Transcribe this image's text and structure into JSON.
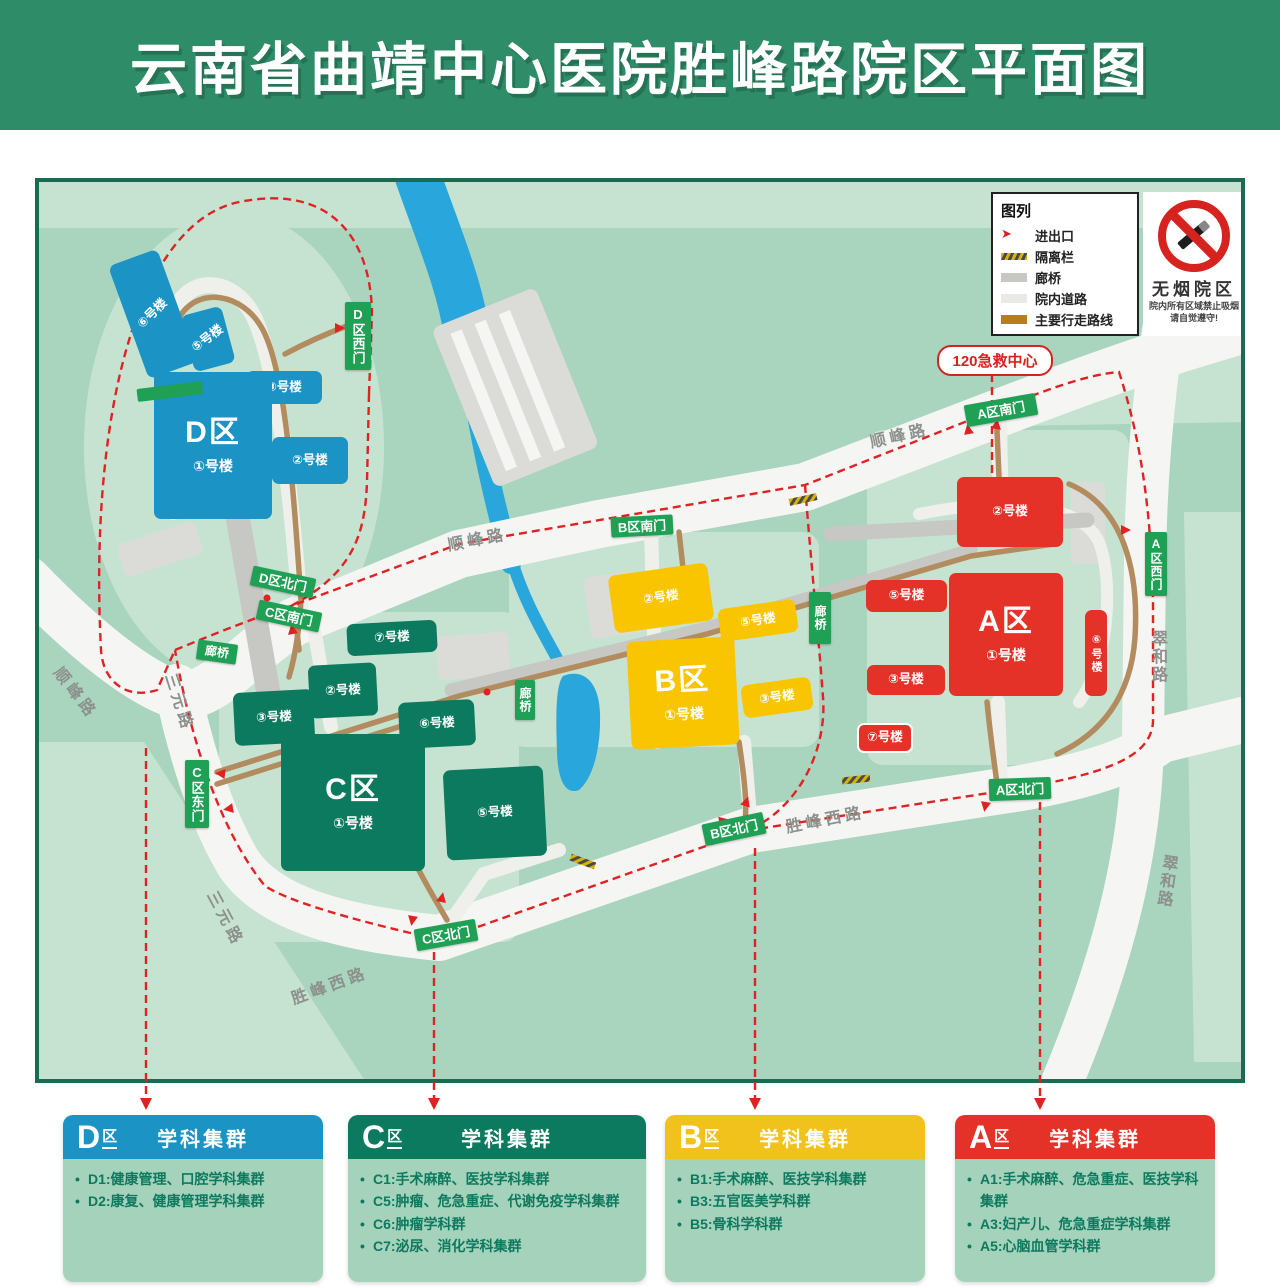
{
  "header": {
    "title": "云南省曲靖中心医院胜峰路院区平面图"
  },
  "legend": {
    "title": "图列",
    "entrance": "进出口",
    "barrier": "隔离栏",
    "corridor": "廊桥",
    "road": "院内道路",
    "route": "主要行走路线"
  },
  "no_smoking": {
    "title": "无烟院区",
    "line1": "院内所有区域禁止吸烟",
    "line2": "请自觉遵守!"
  },
  "emergency_label": "120急救中心",
  "roads": {
    "shunfeng": "顺峰路",
    "sanyuan": "三元路",
    "shengfengxi": "胜峰西路",
    "cuihe": "翠和路"
  },
  "gates": {
    "d_west": "D区西门",
    "d_north": "D区北门",
    "c_south": "C区南门",
    "c_east": "C区东门",
    "c_north": "C区北门",
    "b_south": "B区南门",
    "b_north": "B区北门",
    "a_south": "A区南门",
    "a_west": "A区西门",
    "a_north": "A区北门"
  },
  "corridor_label": "廊桥",
  "zones": {
    "d": {
      "name": "D区",
      "b1": "①号楼",
      "b2": "②号楼",
      "b3": "③号楼",
      "b5": "⑤号楼",
      "b6": "⑥号楼"
    },
    "c": {
      "name": "C区",
      "b1": "①号楼",
      "b2": "②号楼",
      "b3": "③号楼",
      "b5": "⑤号楼",
      "b6": "⑥号楼",
      "b7": "⑦号楼"
    },
    "b": {
      "name": "B区",
      "b1": "①号楼",
      "b2": "②号楼",
      "b3": "③号楼",
      "b5": "⑤号楼"
    },
    "a": {
      "name": "A区",
      "b1": "①号楼",
      "b2": "②号楼",
      "b3": "③号楼",
      "b5": "⑤号楼",
      "b6": "⑥号楼",
      "b7": "⑦号楼"
    }
  },
  "panels": [
    {
      "letter": "D",
      "suffix": "区",
      "title": "学科集群",
      "items": [
        "D1:健康管理、口腔学科集群",
        "D2:康复、健康管理学科集群"
      ]
    },
    {
      "letter": "C",
      "suffix": "区",
      "title": "学科集群",
      "items": [
        "C1:手术麻醉、医技学科集群",
        "C5:肿瘤、危急重症、代谢免疫学科集群",
        "C6:肿瘤学科群",
        "C7:泌尿、消化学科集群"
      ]
    },
    {
      "letter": "B",
      "suffix": "区",
      "title": "学科集群",
      "items": [
        "B1:手术麻醉、医技学科集群",
        "B3:五官医美学科群",
        "B5:骨科学科群"
      ]
    },
    {
      "letter": "A",
      "suffix": "区",
      "title": "学科集群",
      "items": [
        "A1:手术麻醉、危急重症、医技学科集群",
        "A3:妇产儿、危急重症学科集群",
        "A5:心脑血管学科群"
      ]
    }
  ],
  "colors": {
    "zone_d": "#1B93C4",
    "zone_c": "#0C7A5E",
    "zone_b": "#F9C500",
    "zone_a": "#E53228",
    "sign_green": "#1FA054",
    "route_red": "#E02222",
    "walk_brown": "#B28B5E"
  }
}
